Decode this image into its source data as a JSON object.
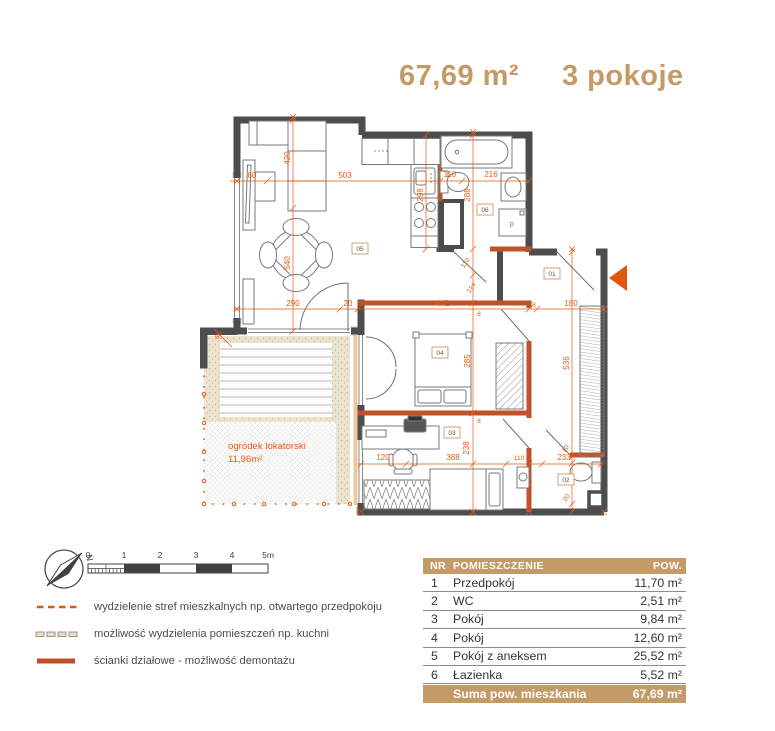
{
  "header": {
    "area": "67,69 m²",
    "rooms": "3 pokoje"
  },
  "plan": {
    "rooms": {
      "r01": "01",
      "r02": "02",
      "r03": "03",
      "r04": "04",
      "r05": "05",
      "r06": "06"
    },
    "garden": {
      "name": "ogródek lokatorski",
      "area": "11,96m²"
    },
    "appliance": {
      "washer": "p"
    },
    "dims": {
      "h80": "80",
      "h503": "503",
      "h110": "110",
      "h216": "216",
      "v420": "420",
      "v540": "540",
      "v298": "298",
      "v288": "288",
      "r110": "110",
      "r124": "124",
      "h290": "290",
      "h20": "20",
      "h442": "442",
      "s8a": "8",
      "h180": "180",
      "s8b": "8",
      "v285": "285",
      "s8c": "8",
      "v238": "238",
      "v536": "536",
      "r10": "10",
      "r20": "20",
      "h120": "120",
      "h388": "388",
      "h110b": "110",
      "h233": "233",
      "t80": "80"
    }
  },
  "compass": {
    "north": "N"
  },
  "scalebar": {
    "ticks": [
      "0",
      "1",
      "2",
      "3",
      "4",
      "5m"
    ]
  },
  "legend": {
    "items": [
      {
        "label": "wydzielenie stref mieszkalnych np. otwartego przedpokoju"
      },
      {
        "label": "możliwość wydzielenia pomieszczeń np. kuchni"
      },
      {
        "label": "ścianki działowe - możliwość demontażu"
      }
    ]
  },
  "table": {
    "headers": {
      "nr": "NR",
      "name": "POMIESZCZENIE",
      "area": "POW."
    },
    "rows": [
      {
        "nr": "1",
        "name": "Przedpokój",
        "area": "11,70 m²"
      },
      {
        "nr": "2",
        "name": "WC",
        "area": "2,51 m²"
      },
      {
        "nr": "3",
        "name": "Pokój",
        "area": "9,84 m²"
      },
      {
        "nr": "4",
        "name": "Pokój",
        "area": "12,60 m²"
      },
      {
        "nr": "5",
        "name": "Pokój z aneksem",
        "area": "25,52 m²"
      },
      {
        "nr": "6",
        "name": "Łazienka",
        "area": "5,52 m²"
      }
    ],
    "footer": {
      "label": "Suma pow. mieszkania",
      "value": "67,69 m²"
    }
  },
  "colors": {
    "accent": "#c49a66",
    "dimension": "#e8590c",
    "partition": "#bf5228",
    "wall": "#4d4d4d"
  }
}
